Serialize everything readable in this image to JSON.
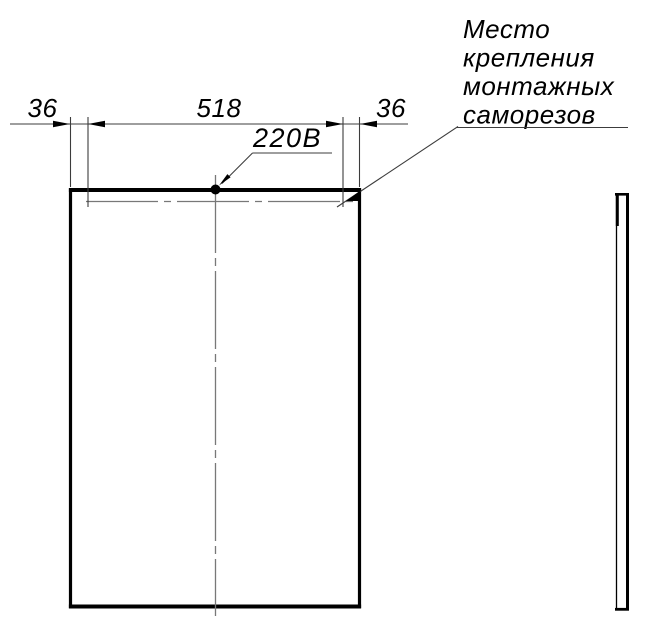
{
  "dimensions": {
    "left": "36",
    "center": "518",
    "right": "36"
  },
  "power_label": "220В",
  "note": {
    "lines": [
      "Место",
      "крепления",
      "монтажных",
      "саморезов"
    ]
  },
  "colors": {
    "object_line": "#000000",
    "thin_line": "#3c3c3c",
    "center_line": "#787878",
    "background": "#ffffff"
  }
}
